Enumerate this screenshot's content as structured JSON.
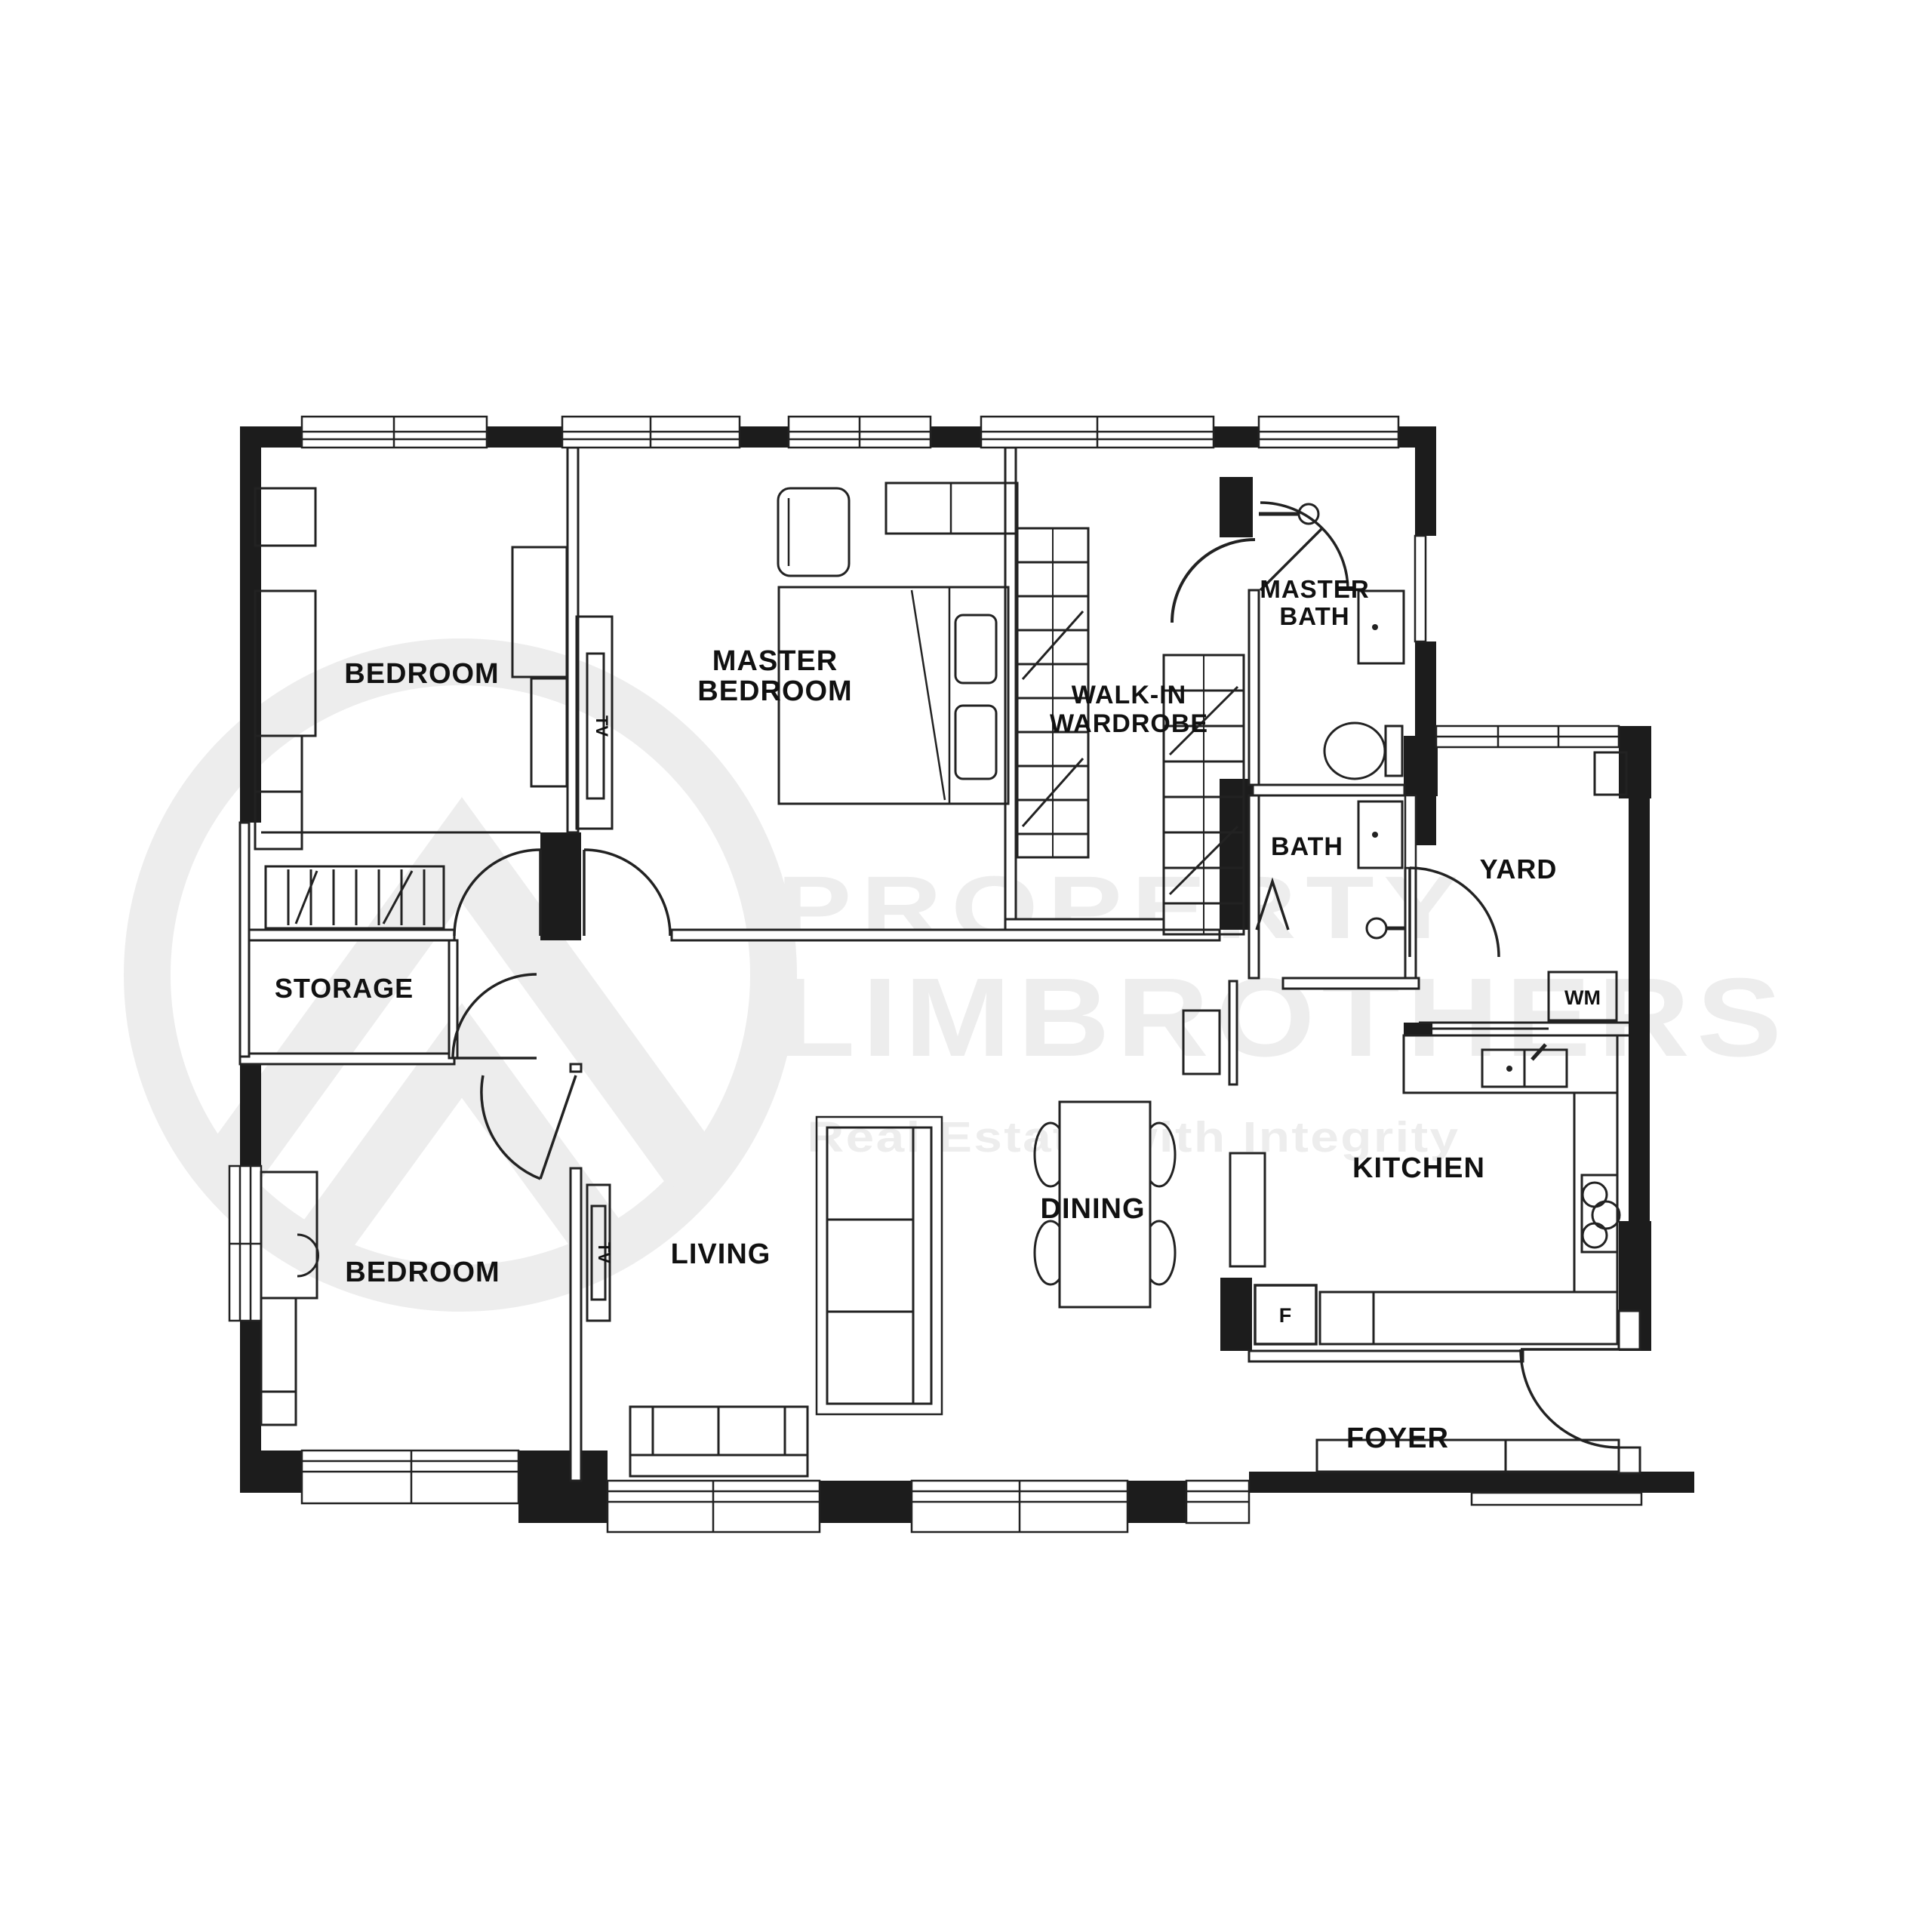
{
  "floorplan": {
    "watermark": {
      "line1": "PROPERTY",
      "line2": "LIMBROTHERS",
      "tagline": "Real Estate with Integrity",
      "color": "#ededed"
    },
    "colors": {
      "wall": "#1c1c1c",
      "line": "#222222",
      "label": "#111111",
      "background": "#ffffff"
    },
    "rooms": {
      "bedroom_top": {
        "label": "BEDROOM"
      },
      "master_bedroom": {
        "line1": "MASTER",
        "line2": "BEDROOM"
      },
      "walk_in_wardrobe": {
        "line1": "WALK-IN",
        "line2": "WARDROBE"
      },
      "master_bath": {
        "line1": "MASTER",
        "line2": "BATH"
      },
      "bath": {
        "label": "BATH"
      },
      "yard": {
        "label": "YARD"
      },
      "storage": {
        "label": "STORAGE"
      },
      "bedroom_bottom": {
        "label": "BEDROOM"
      },
      "living": {
        "label": "LIVING"
      },
      "dining": {
        "label": "DINING"
      },
      "kitchen": {
        "label": "KITCHEN"
      },
      "foyer": {
        "label": "FOYER"
      }
    },
    "appliances": {
      "washing_machine": "WM",
      "fridge": "F",
      "tv_master": "TV",
      "tv_living": "TV"
    }
  }
}
